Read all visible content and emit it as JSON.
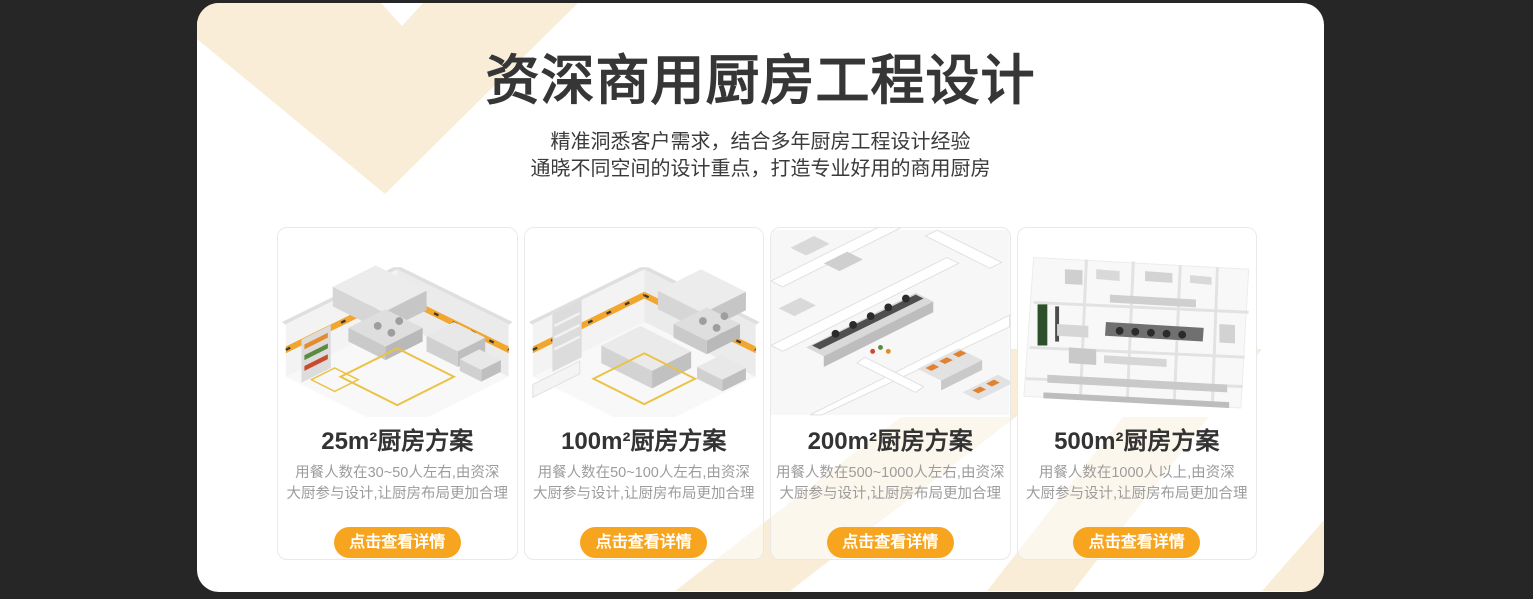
{
  "theme": {
    "background_dark": "#262626",
    "panel_background": "#FFFFFF",
    "accent_orange": "#F7A41E",
    "decor_cream": "#F9EDD8",
    "title_color": "#363636",
    "description_color": "#9C9C9C"
  },
  "header": {
    "title": "资深商用厨房工程设计",
    "subtitle_line1": "精准洞悉客户需求，结合多年厨房工程设计经验",
    "subtitle_line2": "通晓不同空间的设计重点，打造专业好用的商用厨房"
  },
  "cards": [
    {
      "title": "25m²厨房方案",
      "description": "用餐人数在30~50人左右,由资深\n大厨参与设计,让厨房布局更加合理",
      "button_label": "点击查看详情"
    },
    {
      "title": "100m²厨房方案",
      "description": "用餐人数在50~100人左右,由资深\n大厨参与设计,让厨房布局更加合理",
      "button_label": "点击查看详情"
    },
    {
      "title": "200m²厨房方案",
      "description": "用餐人数在500~1000人左右,由资深\n大厨参与设计,让厨房布局更加合理",
      "button_label": "点击查看详情"
    },
    {
      "title": "500m²厨房方案",
      "description": "用餐人数在1000人以上,由资深\n大厨参与设计,让厨房布局更加合理",
      "button_label": "点击查看详情"
    }
  ]
}
